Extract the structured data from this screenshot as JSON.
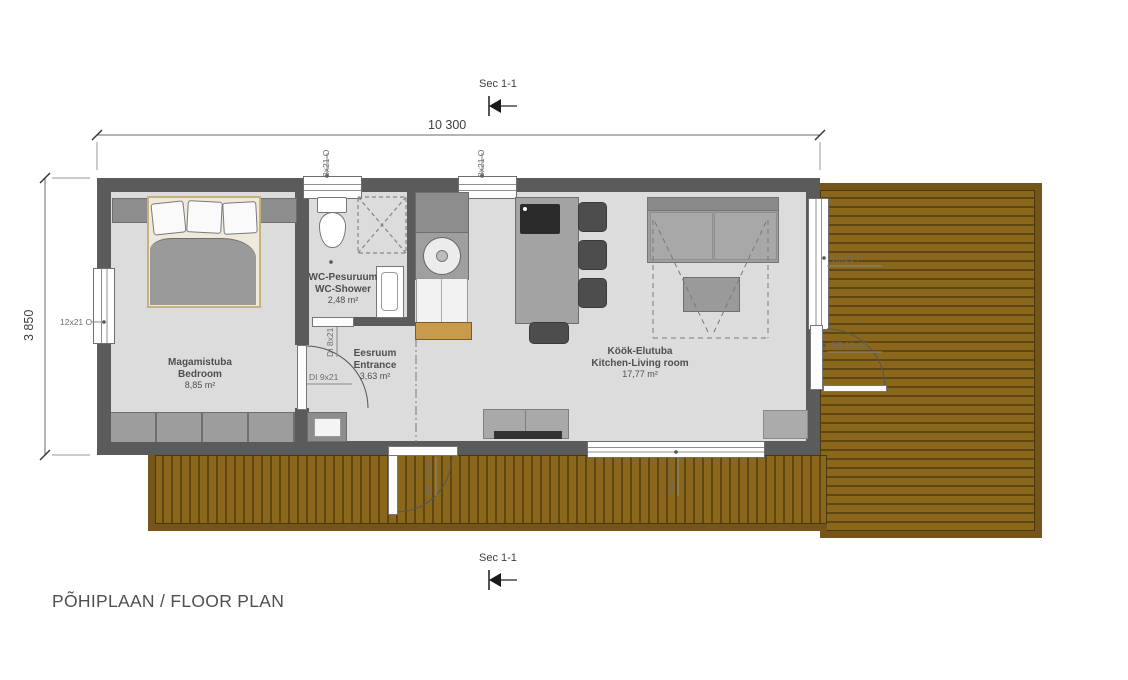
{
  "drawing": {
    "title": "PÕHIPLAAN / FLOOR PLAN",
    "section_label_top": "Sec 1-1",
    "section_label_bottom": "Sec 1-1",
    "dim_width": "10 300",
    "dim_height": "3 850"
  },
  "rooms": {
    "bedroom": {
      "name_et": "Magamistuba",
      "name_en": "Bedroom",
      "area": "8,85 m²"
    },
    "wc": {
      "name_et": "WC-Pesuruum",
      "name_en": "WC-Shower",
      "area": "2,48 m²"
    },
    "entrance": {
      "name_et": "Eesruum",
      "name_en": "Entrance",
      "area": "3,63 m²"
    },
    "living": {
      "name_et": "Köök-Elutuba",
      "name_en": "Kitchen-Living room",
      "area": "17,77 m²"
    }
  },
  "openings": {
    "window_top_left": "8x21 O",
    "window_top_right": "8x21 O",
    "window_west": "12x21 O",
    "window_east": "16x21 F",
    "window_south": "24x21 F",
    "door_bedroom": "DI 9x21",
    "door_wc": "DI 8x21",
    "door_east": "DE 10x21",
    "door_south": "DE 10x21"
  },
  "colors": {
    "wall": "#5b5b5b",
    "floor": "#dcdcdc",
    "deck_plank": "#8b671c",
    "deck_frame": "#74561a",
    "annotation": "#4f4f4f"
  }
}
